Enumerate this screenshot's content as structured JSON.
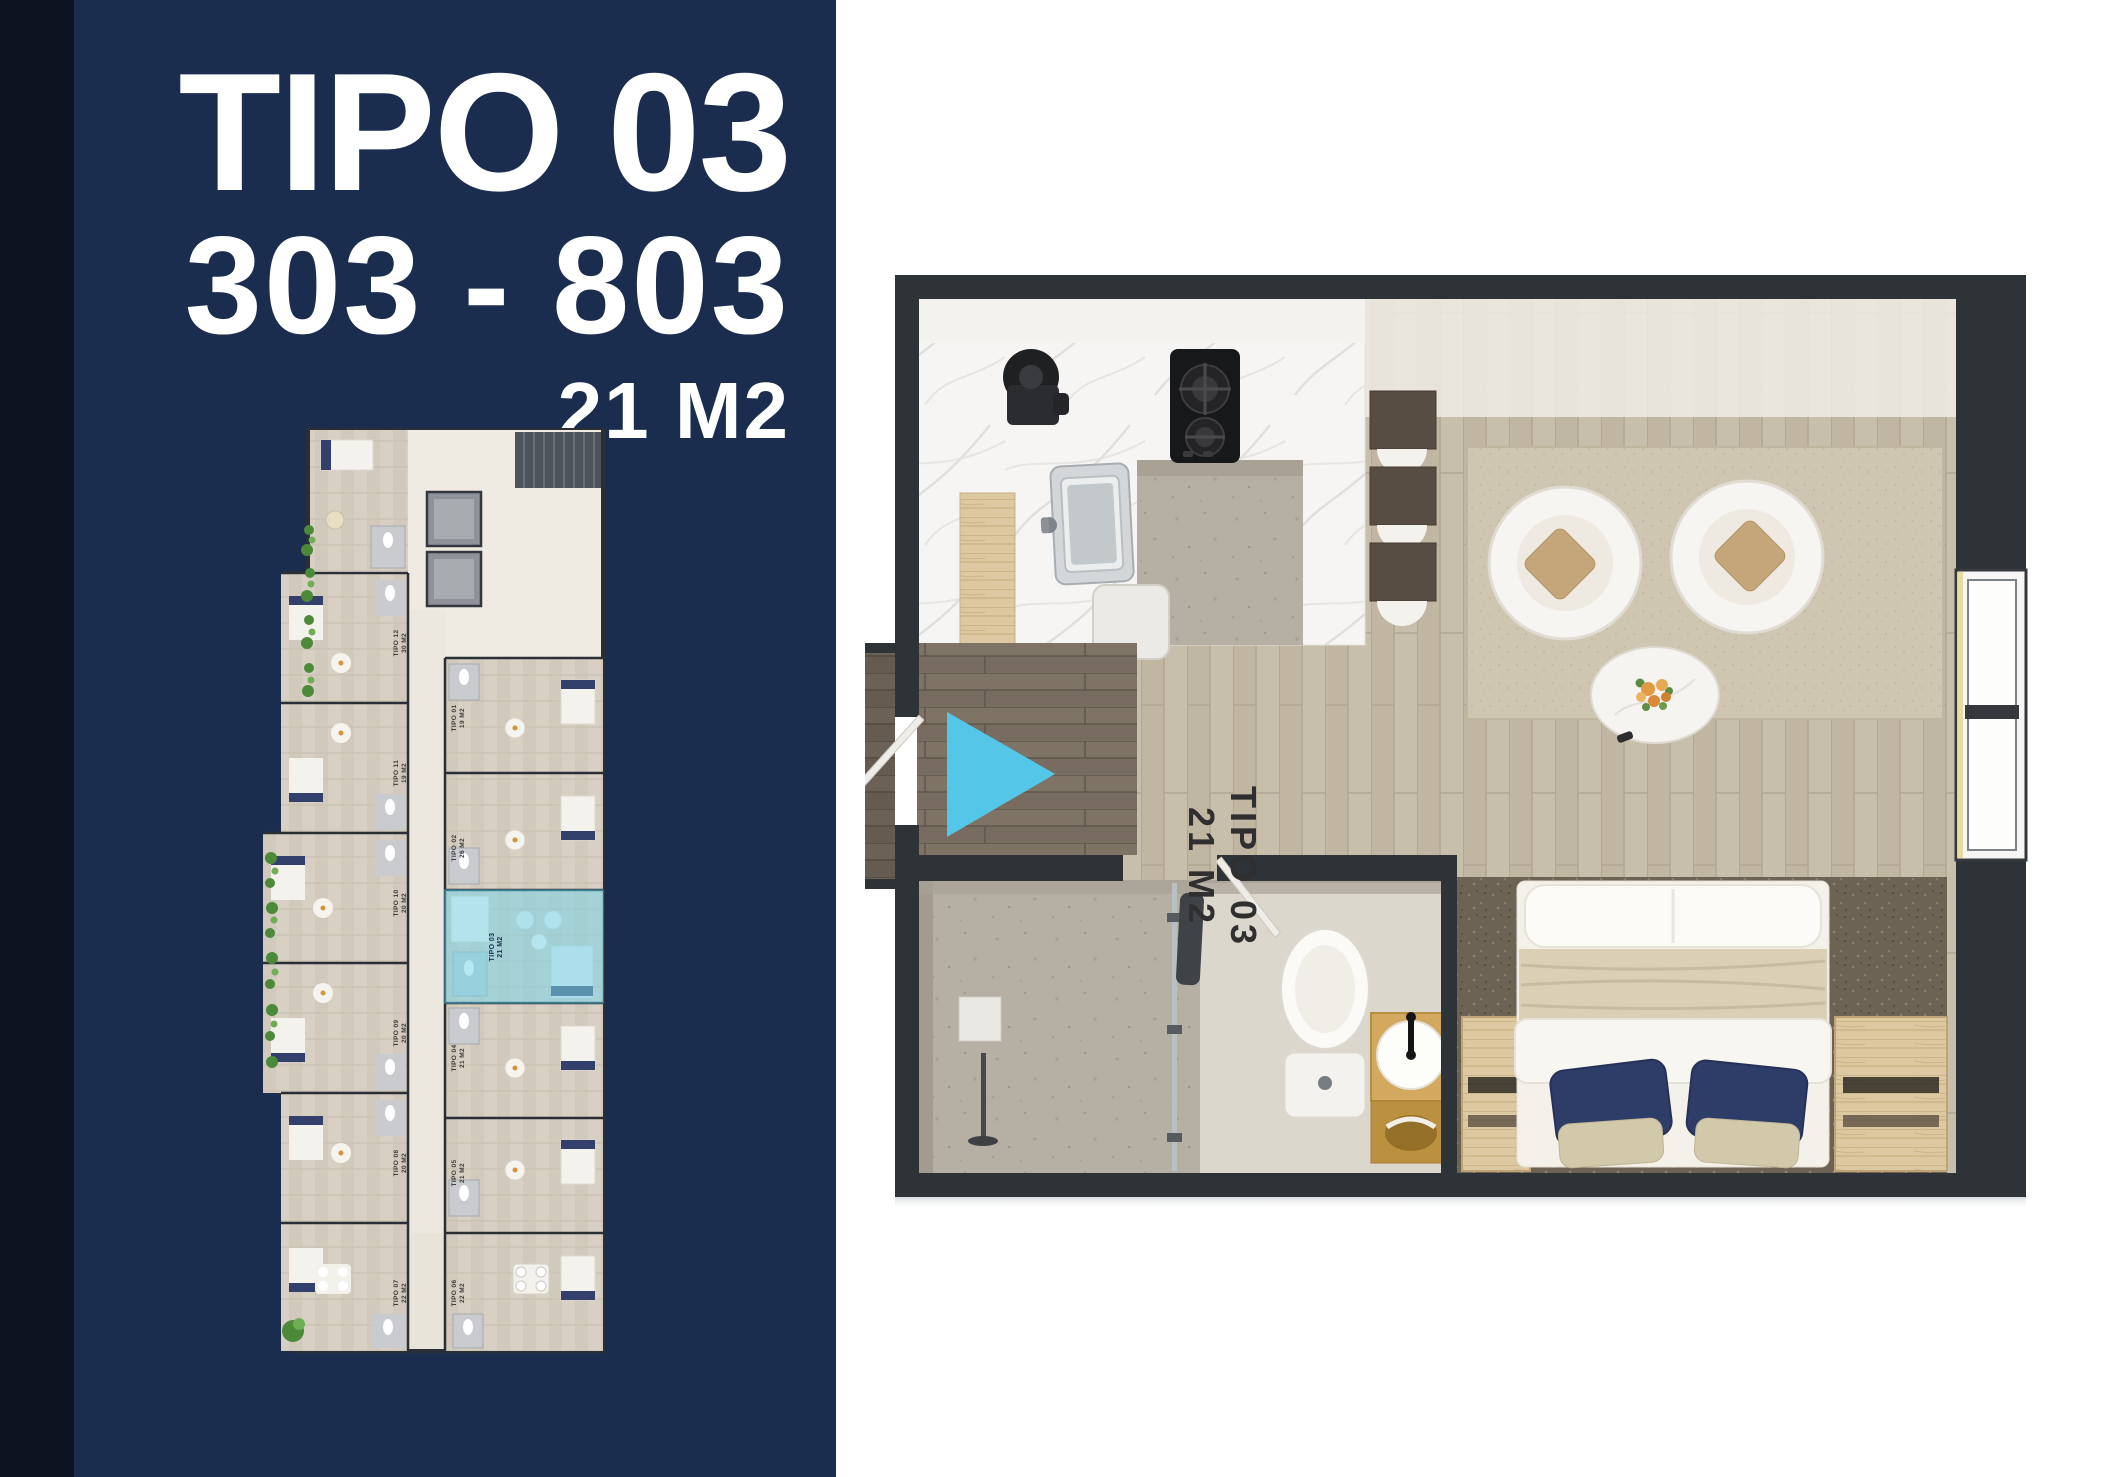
{
  "theme": {
    "navy": "#1b2d4f",
    "edge": "#0e1320",
    "accent": "#54c6e8",
    "wall": "#2e3338",
    "highlight": "#7ed4e8",
    "textdark": "#2f2f30"
  },
  "left_panel": {
    "title": "TIPO 03",
    "units_range": "303 - 803",
    "area": "21 M2"
  },
  "main_plan": {
    "unit_label_line1": "TIPO 03",
    "unit_label_line2": "21 M2",
    "entry_arrow_icon": "play-triangle-right"
  },
  "mini_plan": {
    "highlighted_unit": {
      "line1": "TIPO 03",
      "line2": "21 M2"
    },
    "unit_labels": [
      {
        "line1": "TIPO 12",
        "line2": "30 M2"
      },
      {
        "line1": "TIPO 11",
        "line2": "19 M2"
      },
      {
        "line1": "TIPO 10",
        "line2": "20 M2"
      },
      {
        "line1": "TIPO 09",
        "line2": "20 M2"
      },
      {
        "line1": "TIPO 08",
        "line2": "20 M2"
      },
      {
        "line1": "TIPO 07",
        "line2": "22 M2"
      },
      {
        "line1": "TIPO 01",
        "line2": "19 M2"
      },
      {
        "line1": "TIPO 02",
        "line2": "26 M2"
      },
      {
        "line1": "TIPO 04",
        "line2": "21 M2"
      },
      {
        "line1": "TIPO 05",
        "line2": "21 M2"
      },
      {
        "line1": "TIPO 06",
        "line2": "22 M2"
      }
    ]
  }
}
